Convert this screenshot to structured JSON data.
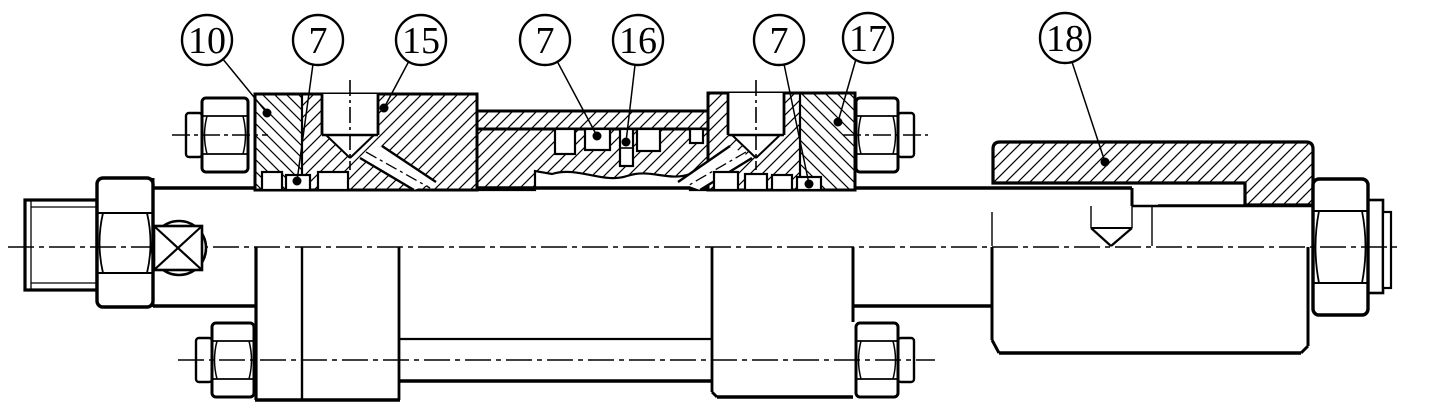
{
  "drawing": {
    "type": "mechanical-assembly-section",
    "paper_color": "#ffffff",
    "ink_color": "#000000",
    "balloons": [
      {
        "label": "10"
      },
      {
        "label": "7"
      },
      {
        "label": "15"
      },
      {
        "label": "7"
      },
      {
        "label": "16"
      },
      {
        "label": "7"
      },
      {
        "label": "17"
      },
      {
        "label": "18"
      }
    ]
  }
}
